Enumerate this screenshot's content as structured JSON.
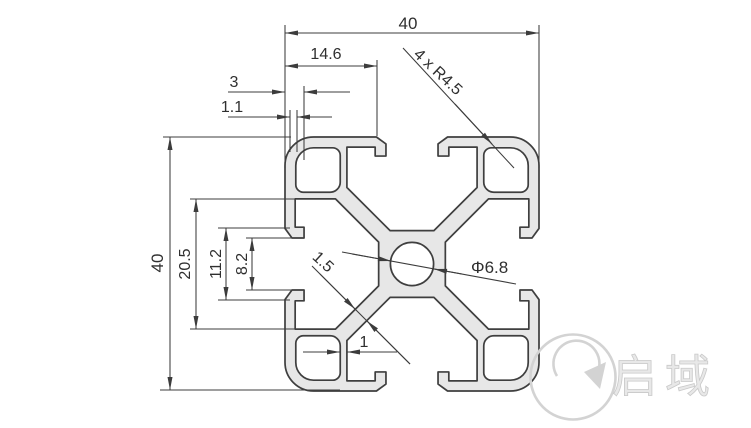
{
  "drawing": {
    "dims": {
      "overall_width": "40",
      "overall_height": "40",
      "slot_edge_offset": "14.6",
      "hook_depth": "3",
      "lip_tip": "1.1",
      "corner_radius": "4 x R4.5",
      "slot_cavity_width": "20.5",
      "slot_outer_opening": "11.2",
      "slot_inner_opening": "8.2",
      "web_thickness": "1.5",
      "center_bore": "Φ6.8",
      "cavity_wall": "1"
    },
    "watermark": {
      "brand": "启域"
    },
    "colors": {
      "profile_fill": "#e7e7e7",
      "outline": "#3f3f3f",
      "dimension": "#3c3c3c",
      "watermark": "#d3d3d3"
    }
  }
}
